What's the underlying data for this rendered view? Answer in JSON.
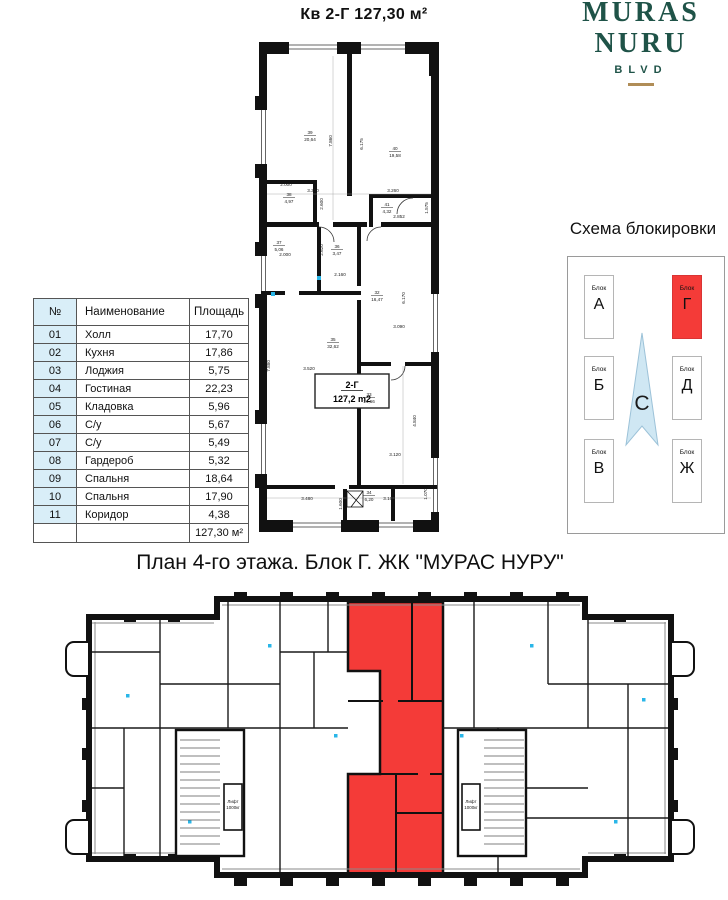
{
  "header": {
    "title": "Кв 2-Г  127,30 м²"
  },
  "logo": {
    "line1": "MURAS",
    "line2": "NURU",
    "line3": "BLVD"
  },
  "room_table": {
    "headers": [
      "№",
      "Наименование",
      "Площадь"
    ],
    "rows": [
      {
        "num": "01",
        "name": "Холл",
        "area": "17,70"
      },
      {
        "num": "02",
        "name": "Кухня",
        "area": "17,86"
      },
      {
        "num": "03",
        "name": "Лоджия",
        "area": "5,75"
      },
      {
        "num": "04",
        "name": "Гостиная",
        "area": "22,23"
      },
      {
        "num": "05",
        "name": "Кладовка",
        "area": "5,96"
      },
      {
        "num": "06",
        "name": "С/у",
        "area": "5,67"
      },
      {
        "num": "07",
        "name": "С/у",
        "area": "5,49"
      },
      {
        "num": "08",
        "name": "Гардероб",
        "area": "5,32"
      },
      {
        "num": "09",
        "name": "Спальня",
        "area": "18,64"
      },
      {
        "num": "10",
        "name": "Спальня",
        "area": "17,90"
      },
      {
        "num": "11",
        "name": "Коридор",
        "area": "4,38"
      }
    ],
    "total": "127,30 м²"
  },
  "unit_plan": {
    "unit_label": "2-Г",
    "unit_area": "127,2 m2",
    "rooms": [
      {
        "num": "39",
        "area": "20,64",
        "x": 57,
        "y": 98
      },
      {
        "num": "40",
        "area": "19,58",
        "x": 142,
        "y": 114
      },
      {
        "num": "38",
        "area": "4,97",
        "x": 36,
        "y": 160
      },
      {
        "num": "41",
        "area": "4,32",
        "x": 134,
        "y": 170
      },
      {
        "num": "37",
        "area": "5,06",
        "x": 26,
        "y": 208
      },
      {
        "num": "36",
        "area": "3,47",
        "x": 84,
        "y": 212
      },
      {
        "num": "32",
        "area": "16,47",
        "x": 124,
        "y": 258
      },
      {
        "num": "35",
        "area": "32,62",
        "x": 80,
        "y": 305
      },
      {
        "num": "33",
        "area": "14,66",
        "x": 116,
        "y": 360
      },
      {
        "num": "34",
        "area": "6,20",
        "x": 116,
        "y": 458
      }
    ],
    "dims": [
      {
        "t": "3.350",
        "x": 60,
        "y": 156
      },
      {
        "t": "3.260",
        "x": 140,
        "y": 156
      },
      {
        "t": "7.860",
        "x": 79,
        "y": 105,
        "r": 1
      },
      {
        "t": "6.175",
        "x": 110,
        "y": 108,
        "r": 1
      },
      {
        "t": "2.000",
        "x": 33,
        "y": 150
      },
      {
        "t": "2.600",
        "x": 70,
        "y": 168,
        "r": 1
      },
      {
        "t": "2.852",
        "x": 146,
        "y": 182
      },
      {
        "t": "1.575",
        "x": 175,
        "y": 172,
        "r": 1
      },
      {
        "t": "2.000",
        "x": 32,
        "y": 220
      },
      {
        "t": "2.620",
        "x": 70,
        "y": 214,
        "r": 1
      },
      {
        "t": "2.160",
        "x": 87,
        "y": 240
      },
      {
        "t": "6.170",
        "x": 152,
        "y": 262,
        "r": 1
      },
      {
        "t": "3.090",
        "x": 146,
        "y": 292
      },
      {
        "t": "3.520",
        "x": 56,
        "y": 334
      },
      {
        "t": "7.880",
        "x": 17,
        "y": 330,
        "r": 1
      },
      {
        "t": "4.840",
        "x": 163,
        "y": 385,
        "r": 1
      },
      {
        "t": "3.120",
        "x": 142,
        "y": 420
      },
      {
        "t": "3.480",
        "x": 54,
        "y": 464
      },
      {
        "t": "3.160",
        "x": 136,
        "y": 464
      },
      {
        "t": "1.070",
        "x": 174,
        "y": 458,
        "r": 1
      },
      {
        "t": "1.600",
        "x": 89,
        "y": 468,
        "r": 1
      }
    ]
  },
  "blocking_scheme": {
    "title": "Схема блокировки",
    "block_caption": "Блок",
    "blocks": [
      {
        "letter": "А",
        "highlighted": false
      },
      {
        "letter": "Г",
        "highlighted": true
      },
      {
        "letter": "Б",
        "highlighted": false
      },
      {
        "letter": "Д",
        "highlighted": false
      },
      {
        "letter": "В",
        "highlighted": false
      },
      {
        "letter": "Ж",
        "highlighted": false
      }
    ],
    "compass_letter": "С"
  },
  "floor_plan": {
    "title": "План 4-го этажа. Блок Г. ЖК \"МУРАС НУРУ\"",
    "elevator_line1": "Лифт",
    "elevator_line2": "1000кг"
  },
  "colors": {
    "highlight_red": "#f43b38",
    "table_num_bg": "#d9eef8",
    "logo_green": "#1f5348",
    "logo_gold": "#b08d57",
    "compass_fill": "#cfe7f3",
    "compass_stroke": "#9cc2d8",
    "wall_black": "#111111",
    "marker_cyan": "#29b6e8"
  }
}
